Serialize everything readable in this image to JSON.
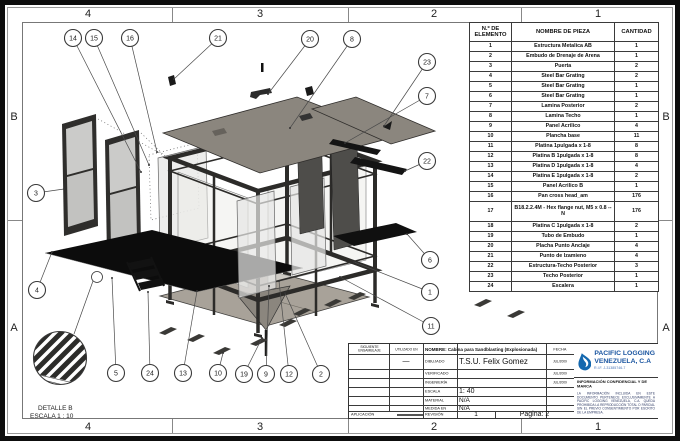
{
  "page": {
    "zones_top": [
      "4",
      "3",
      "2",
      "1"
    ],
    "zones_bottom": [
      "4",
      "3",
      "2",
      "1"
    ],
    "zones_left": [
      "B",
      "A"
    ],
    "zones_right": [
      "B",
      "A"
    ]
  },
  "bom": {
    "headers": {
      "element": "N.º DE ELEMENTO",
      "name": "NOMBRE DE PIEZA",
      "qty": "CANTIDAD"
    },
    "rows": [
      {
        "n": "1",
        "name": "Estructura Metalica AB",
        "qty": "1"
      },
      {
        "n": "2",
        "name": "Embudo de Drenaje de Arena",
        "qty": "1"
      },
      {
        "n": "3",
        "name": "Puerta",
        "qty": "2"
      },
      {
        "n": "4",
        "name": "Steel Bar Grating",
        "qty": "2"
      },
      {
        "n": "5",
        "name": "Steel Bar Grating",
        "qty": "1"
      },
      {
        "n": "6",
        "name": "Steel Bar Grating",
        "qty": "1"
      },
      {
        "n": "7",
        "name": "Lamina Posterior",
        "qty": "2"
      },
      {
        "n": "8",
        "name": "Lamina Techo",
        "qty": "1"
      },
      {
        "n": "9",
        "name": "Panel Acrilico",
        "qty": "4"
      },
      {
        "n": "10",
        "name": "Plancha base",
        "qty": "11"
      },
      {
        "n": "11",
        "name": "Platina 1pulgada x 1-8",
        "qty": "8"
      },
      {
        "n": "12",
        "name": "Platina B 1pulgada x 1-8",
        "qty": "8"
      },
      {
        "n": "13",
        "name": "Platina D 1pulgada x 1-8",
        "qty": "4"
      },
      {
        "n": "14",
        "name": "Platina E 1pulgada x 1-8",
        "qty": "2"
      },
      {
        "n": "15",
        "name": "Panel Acrilico B",
        "qty": "1"
      },
      {
        "n": "16",
        "name": "Pan cross head_am",
        "qty": "176"
      },
      {
        "n": "17",
        "name": "B18.2.2.4M - Hex flange nut, M5 x 0.8 --N",
        "qty": "176"
      },
      {
        "n": "18",
        "name": "Platina C 1pulgada x 1-8",
        "qty": "2"
      },
      {
        "n": "19",
        "name": "Tubo de Embudo",
        "qty": "1"
      },
      {
        "n": "20",
        "name": "Placha Punto Anclaje",
        "qty": "4"
      },
      {
        "n": "21",
        "name": "Punto de Izamieno",
        "qty": "4"
      },
      {
        "n": "22",
        "name": "Estructura-Techo Posterior",
        "qty": "3"
      },
      {
        "n": "23",
        "name": "Techo Posterior",
        "qty": "1"
      },
      {
        "n": "24",
        "name": "Escalera",
        "qty": "1"
      }
    ]
  },
  "detail": {
    "title": "DETALLE B",
    "scale": "ESCALA 1 : 10"
  },
  "title_block": {
    "siguiente_label": "SIGUIENTE ENSAMBLAJE",
    "utilizado_label": "UTILIZADO EN",
    "utilizado_value": "—",
    "nombre": "NOMBRE: Cabina para Sandblasting (Explosionada)",
    "fecha_label": "FECHA",
    "rows": [
      {
        "label": "DIBUJADO",
        "value": "T.S.U. Felix Gomez",
        "date": "JUL/2009"
      },
      {
        "label": "VERIFICADO",
        "value": "",
        "date": "JUL/2009"
      },
      {
        "label": "INGENIERÍA",
        "value": "",
        "date": "JUL/2009"
      }
    ],
    "escala_label": "ESCALA",
    "escala_value": "1: 40",
    "material_label": "MATERIAL",
    "material_value": "N/A",
    "medida_label": "MEDIDA EN",
    "medida_value": "N/A",
    "aplicacion_label": "APLICACIÓN",
    "revision_label": "REVISIÓN",
    "revision_value": "1",
    "pagina": "Pagina: 2"
  },
  "company": {
    "name_line1": "PACIFIC LOGGING",
    "name_line2": "VENEZUELA, C.A",
    "rif": "R.I.F. J-31385746-7",
    "confidential_title": "INFORMACIÓN CONFIDENCIAL Y DE MARCA",
    "confidential_body": "LA INFORMACIÓN INCLUIDA EN ESTE DOCUMENTO PERTENECE EXCLUSIVAMENTE A PACIFIC LOGGING VENEZUELA, C.A. QUEDA PROHIBIDA LA REPRODUCCIÓN TOTAL O PARCIAL SIN EL PREVIO CONSENTIMIENTO POR ESCRITO DE LA EMPRESA.",
    "logo_color": "#1468af"
  },
  "drawing": {
    "balloons": [
      {
        "label": "14",
        "x": 73,
        "y": 38,
        "tx": 141,
        "ty": 172
      },
      {
        "label": "15",
        "x": 94,
        "y": 38,
        "tx": 149,
        "ty": 165
      },
      {
        "label": "16",
        "x": 130,
        "y": 38,
        "tx": 157,
        "ty": 152
      },
      {
        "label": "21",
        "x": 218,
        "y": 38,
        "tx": 174,
        "ty": 79
      },
      {
        "label": "20",
        "x": 310,
        "y": 39,
        "tx": 268,
        "ty": 94
      },
      {
        "label": "8",
        "x": 352,
        "y": 39,
        "tx": 290,
        "ty": 128
      },
      {
        "label": "23",
        "x": 427,
        "y": 62,
        "tx": 384,
        "ty": 126
      },
      {
        "label": "7",
        "x": 427,
        "y": 96,
        "tx": 345,
        "ty": 143
      },
      {
        "label": "22",
        "x": 427,
        "y": 161,
        "tx": 405,
        "ty": 171
      },
      {
        "label": "3",
        "x": 36,
        "y": 193,
        "tx": 64,
        "ty": 189
      },
      {
        "label": "4",
        "x": 37,
        "y": 290,
        "tx": 52,
        "ty": 252
      },
      {
        "label": "6",
        "x": 430,
        "y": 260,
        "tx": 407,
        "ty": 234
      },
      {
        "label": "1",
        "x": 430,
        "y": 292,
        "tx": 354,
        "ty": 262
      },
      {
        "label": "11",
        "x": 431,
        "y": 326,
        "tx": 340,
        "ty": 277
      },
      {
        "label": "5",
        "x": 116,
        "y": 373,
        "tx": 112,
        "ty": 278
      },
      {
        "label": "24",
        "x": 150,
        "y": 373,
        "tx": 148,
        "ty": 292
      },
      {
        "label": "13",
        "x": 183,
        "y": 373,
        "tx": 197,
        "ty": 291
      },
      {
        "label": "10",
        "x": 218,
        "y": 373,
        "tx": 223,
        "ty": 353
      },
      {
        "label": "19",
        "x": 244,
        "y": 374,
        "tx": 262,
        "ty": 338
      },
      {
        "label": "9",
        "x": 266,
        "y": 374,
        "tx": 269,
        "ty": 286
      },
      {
        "label": "12",
        "x": 289,
        "y": 374,
        "tx": 279,
        "ty": 281
      },
      {
        "label": "2",
        "x": 321,
        "y": 374,
        "tx": 285,
        "ty": 293
      }
    ]
  }
}
